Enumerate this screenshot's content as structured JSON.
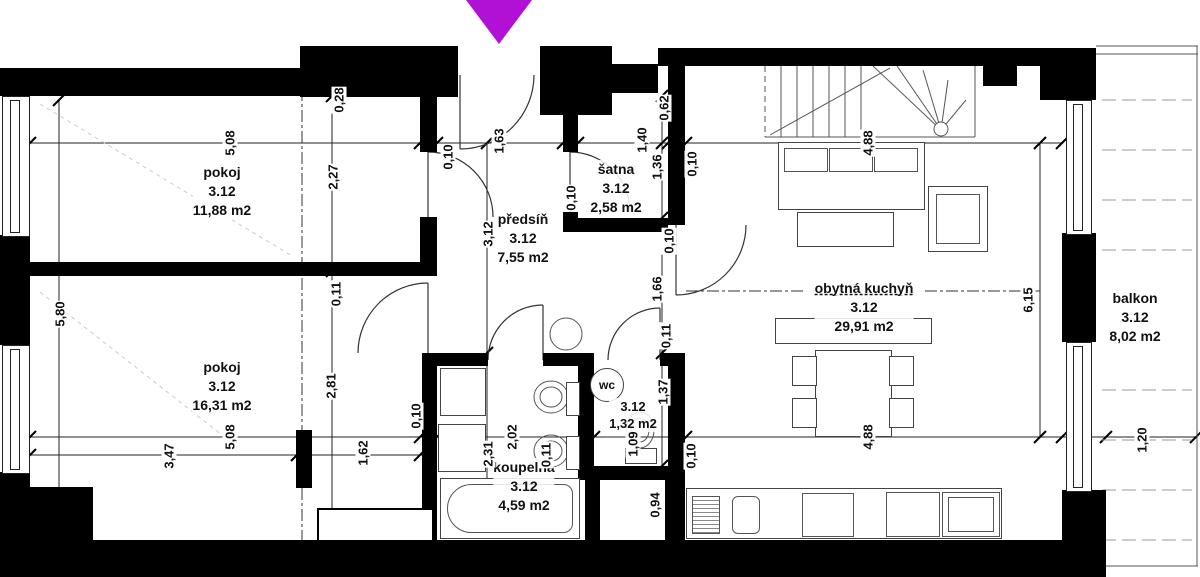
{
  "marker": {
    "color": "#b011d4"
  },
  "rooms": [
    {
      "id": "pokoj1",
      "name": "pokoj",
      "unit": "3.12",
      "area": "11,88 m2"
    },
    {
      "id": "pokoj2",
      "name": "pokoj",
      "unit": "3.12",
      "area": "16,31 m2"
    },
    {
      "id": "predsin",
      "name": "předsíň",
      "unit": "3.12",
      "area": "7,55 m2"
    },
    {
      "id": "satna",
      "name": "šatna",
      "unit": "3.12",
      "area": "2,58 m2"
    },
    {
      "id": "koupelna",
      "name": "koupelna",
      "unit": "3.12",
      "area": "4,59 m2"
    },
    {
      "id": "wc",
      "name": "wc",
      "unit": "3.12",
      "area": "1,32 m2"
    },
    {
      "id": "kuchyn",
      "name": "obytná kuchyň",
      "unit": "3.12",
      "area": "29,91 m2"
    },
    {
      "id": "balkon",
      "name": "balkon",
      "unit": "3.12",
      "area": "8,02 m2"
    }
  ],
  "dimensions": [
    {
      "t": "5,08",
      "x": 230,
      "y": 143
    },
    {
      "t": "0,10",
      "x": 448,
      "y": 157
    },
    {
      "t": "1,63",
      "x": 499,
      "y": 141
    },
    {
      "t": "0,10",
      "x": 571,
      "y": 198
    },
    {
      "t": "1,40",
      "x": 642,
      "y": 140
    },
    {
      "t": "0,62",
      "x": 664,
      "y": 108
    },
    {
      "t": "1,36",
      "x": 657,
      "y": 167
    },
    {
      "t": "0,10",
      "x": 692,
      "y": 164
    },
    {
      "t": "4,88",
      "x": 868,
      "y": 143
    },
    {
      "t": "2,27",
      "x": 333,
      "y": 177
    },
    {
      "t": "0,11",
      "x": 336,
      "y": 294
    },
    {
      "t": "2,81",
      "x": 331,
      "y": 386
    },
    {
      "t": "3,12",
      "x": 488,
      "y": 234
    },
    {
      "t": "0,28",
      "x": 339,
      "y": 100
    },
    {
      "t": "5,80",
      "x": 60,
      "y": 314
    },
    {
      "t": "0,10",
      "x": 669,
      "y": 241
    },
    {
      "t": "1,66",
      "x": 657,
      "y": 289
    },
    {
      "t": "0,11",
      "x": 666,
      "y": 336
    },
    {
      "t": "1,37",
      "x": 663,
      "y": 392
    },
    {
      "t": "0,11",
      "x": 546,
      "y": 455
    },
    {
      "t": "1,09",
      "x": 633,
      "y": 444
    },
    {
      "t": "0,10",
      "x": 691,
      "y": 456
    },
    {
      "t": "0,94",
      "x": 655,
      "y": 505
    },
    {
      "t": "6,15",
      "x": 1028,
      "y": 300
    },
    {
      "t": "4,88",
      "x": 868,
      "y": 437
    },
    {
      "t": "1,20",
      "x": 1142,
      "y": 440
    },
    {
      "t": "5,08",
      "x": 230,
      "y": 437
    },
    {
      "t": "3,47",
      "x": 169,
      "y": 456
    },
    {
      "t": "1,62",
      "x": 363,
      "y": 453
    },
    {
      "t": "0,10",
      "x": 416,
      "y": 416
    },
    {
      "t": "2,31",
      "x": 488,
      "y": 454
    },
    {
      "t": "2,02",
      "x": 512,
      "y": 437
    }
  ]
}
